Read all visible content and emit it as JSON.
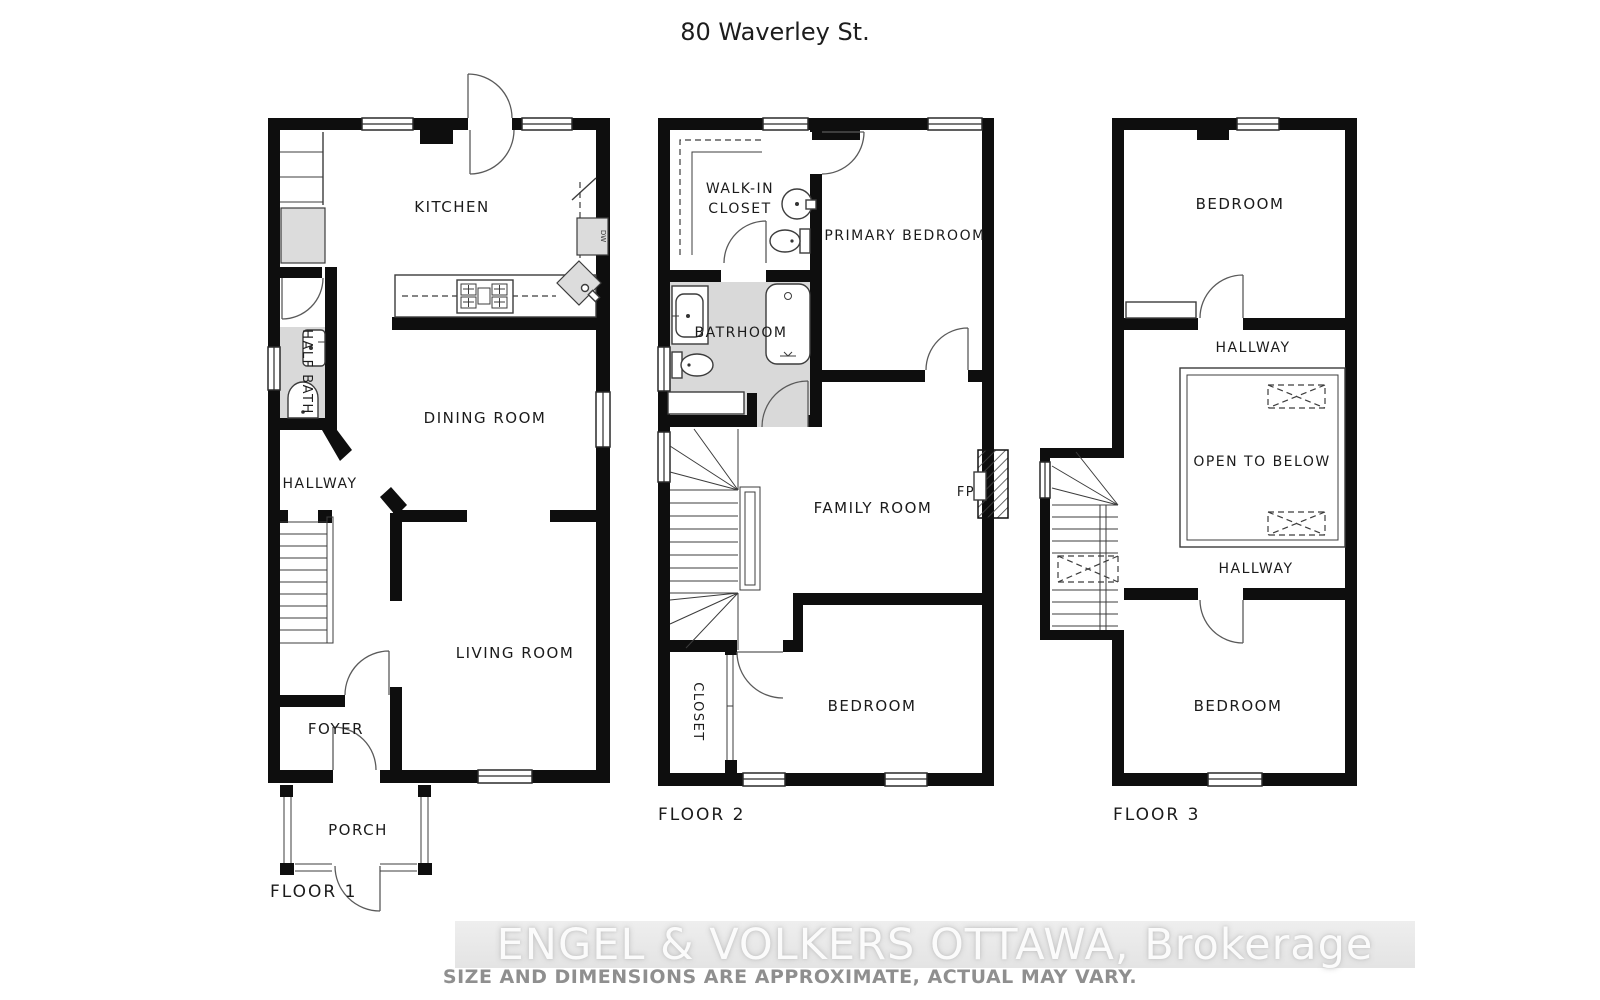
{
  "title": "80 Waverley St.",
  "floor1": {
    "caption": "FLOOR 1",
    "rooms": {
      "kitchen": "KITCHEN",
      "half_bath": "HALF BATH",
      "hallway": "HALLWAY",
      "dining_room": "DINING ROOM",
      "living_room": "LIVING ROOM",
      "foyer": "FOYER",
      "porch": "PORCH"
    },
    "appliances": {
      "dishwasher": "DW"
    }
  },
  "floor2": {
    "caption": "FLOOR 2",
    "rooms": {
      "walk_in_closet_line1": "WALK-IN",
      "walk_in_closet_line2": "CLOSET",
      "primary_bedroom": "PRIMARY BEDROOM",
      "bathroom": "BATRHOOM",
      "family_room": "FAMILY ROOM",
      "bedroom": "BEDROOM",
      "closet": "CLOSET"
    },
    "features": {
      "fireplace": "FP"
    }
  },
  "floor3": {
    "caption": "FLOOR 3",
    "rooms": {
      "bedroom_top": "BEDROOM",
      "hallway_top": "HALLWAY",
      "open_to_below": "OPEN TO BELOW",
      "hallway_bottom": "HALLWAY",
      "bedroom_bottom": "BEDROOM"
    }
  },
  "watermark": {
    "brand": "ENGEL & VOLKERS OTTAWA, Brokerage",
    "disclaimer": "SIZE AND DIMENSIONS ARE APPROXIMATE, ACTUAL MAY VARY."
  }
}
